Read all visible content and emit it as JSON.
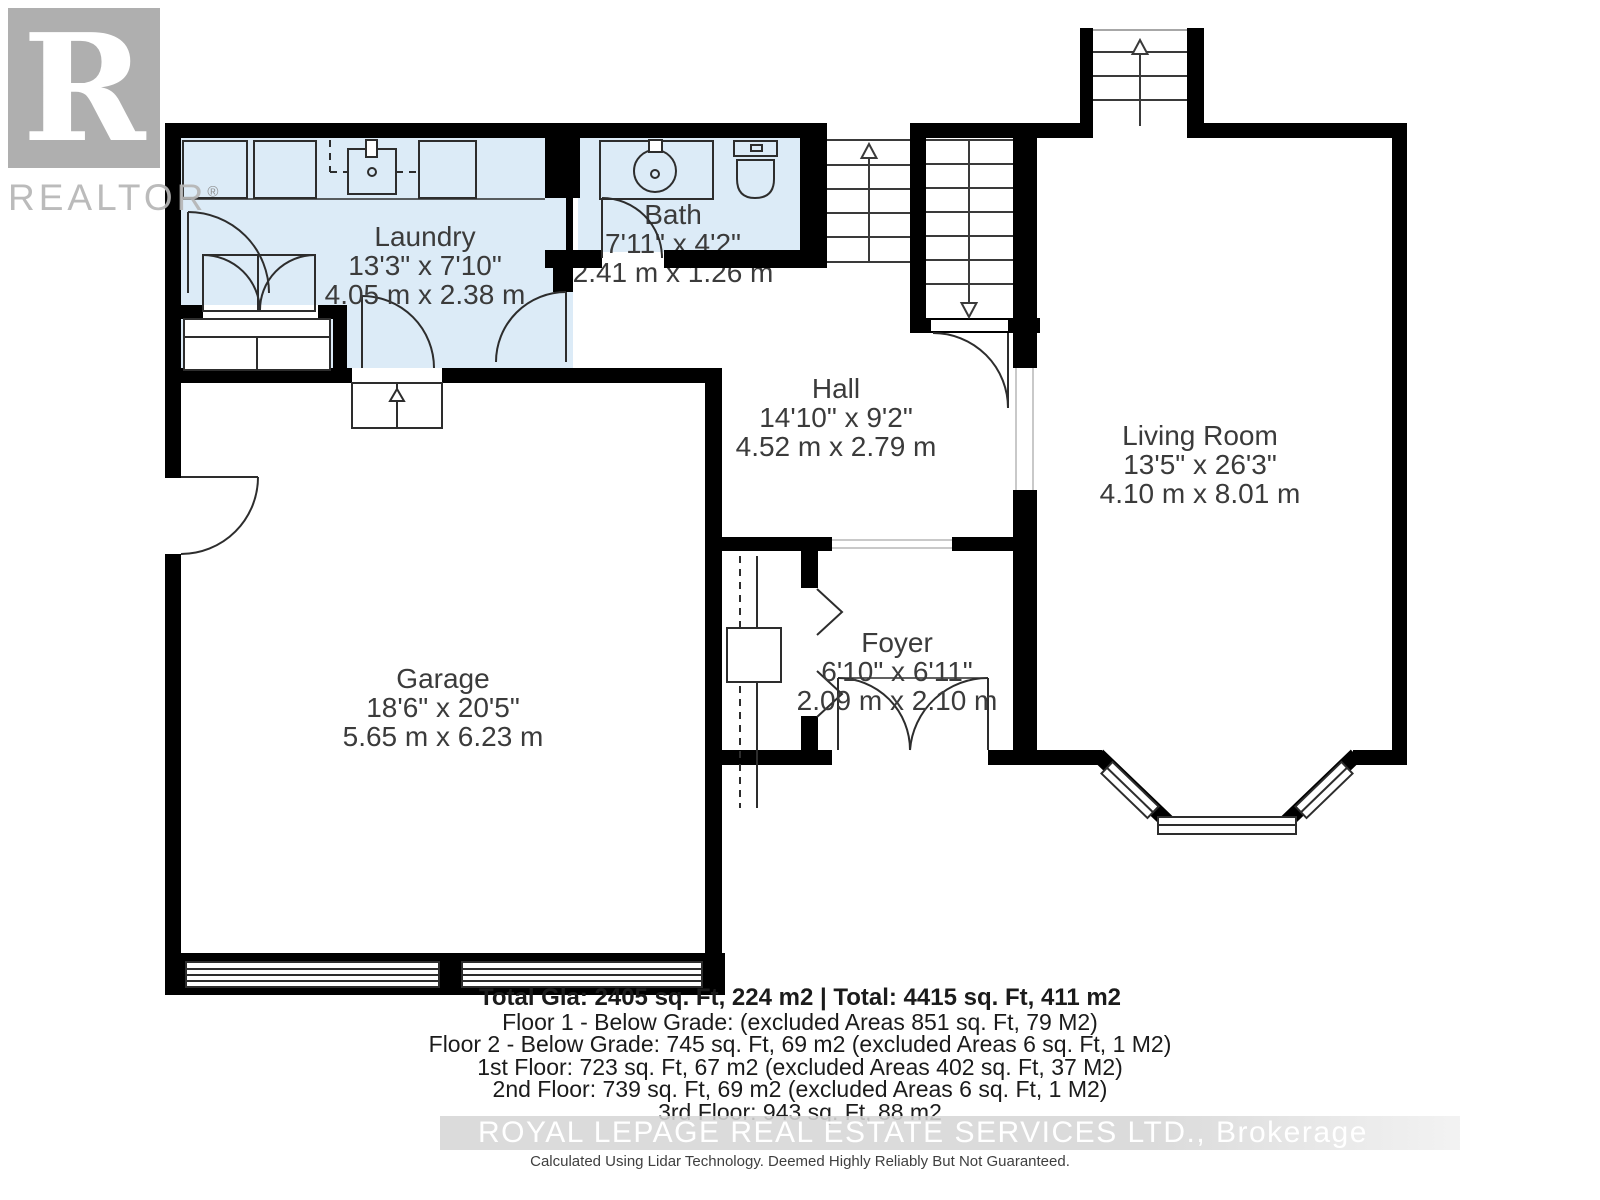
{
  "branding": {
    "logo_letter": "R",
    "logo_word": "REALTOR",
    "registered_mark": "®"
  },
  "rooms": [
    {
      "name": "Laundry",
      "imperial": "13'3\" x 7'10\"",
      "metric": "4.05 m x 2.38 m"
    },
    {
      "name": "Bath",
      "imperial": "7'11\" x 4'2\"",
      "metric": "2.41 m x 1.26 m"
    },
    {
      "name": "Hall",
      "imperial": "14'10\" x 9'2\"",
      "metric": "4.52 m x 2.79 m"
    },
    {
      "name": "Living Room",
      "imperial": "13'5\" x 26'3\"",
      "metric": "4.10 m x 8.01 m"
    },
    {
      "name": "Garage",
      "imperial": "18'6\" x 20'5\"",
      "metric": "5.65 m x 6.23 m"
    },
    {
      "name": "Foyer",
      "imperial": "6'10\" x 6'11\"",
      "metric": "2.09 m x 2.10 m"
    }
  ],
  "summary": {
    "total_line": "Total Gla: 2405 sq. Ft, 224 m2 | Total: 4415 sq. Ft, 411 m2",
    "floor_lines": [
      "Floor 1 - Below Grade: (excluded Areas 851 sq. Ft, 79 M2)",
      "Floor 2 - Below Grade: 745 sq. Ft, 69 m2 (excluded Areas 6 sq. Ft, 1 M2)",
      "1st Floor: 723 sq. Ft, 67 m2 (excluded Areas 402 sq. Ft, 37 M2)",
      "2nd Floor: 739 sq. Ft, 69 m2 (excluded Areas 6 sq. Ft, 1 M2)",
      "3rd Floor: 943 sq. Ft, 88 m2"
    ],
    "brokerage_watermark": "ROYAL LEPAGE REAL ESTATE SERVICES LTD., Brokerage",
    "disclaimer": "Calculated Using Lidar Technology. Deemed Highly Reliably But Not Guaranteed."
  },
  "colors": {
    "wall": "#000000",
    "wet_room_fill": "#dcebf7",
    "line": "#2d2d2d",
    "label_text": "#3b3b3b",
    "logo_gray": "#a9a9a9",
    "watermark_band": "#d6d6d6",
    "watermark_text": "#ffffff"
  }
}
